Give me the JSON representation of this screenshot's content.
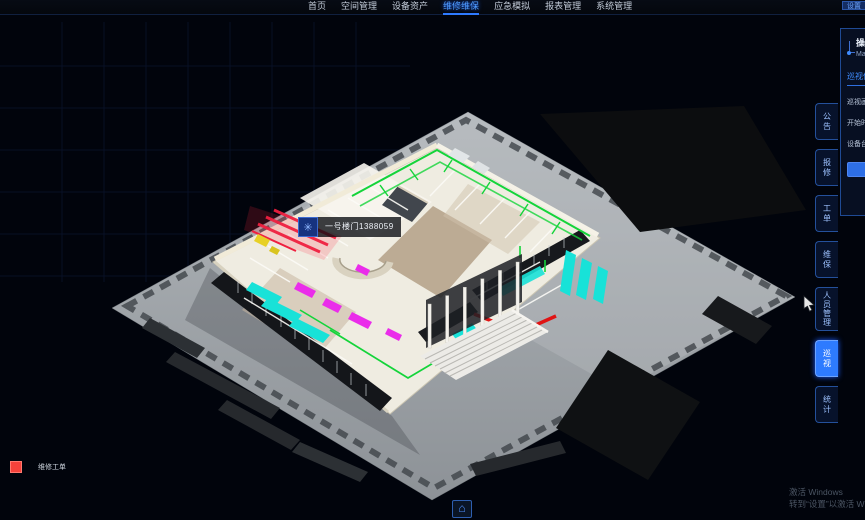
{
  "nav": {
    "items": [
      "首页",
      "空间管理",
      "设备资产",
      "维修维保",
      "应急模拟",
      "报表管理",
      "系统管理"
    ],
    "active": "维修维保",
    "active_index": 3,
    "corner_chip": "设置"
  },
  "side_rail": {
    "tabs": [
      "公告",
      "报修",
      "工单",
      "维保",
      "人员管理",
      "巡视",
      "统计"
    ],
    "active": "巡视",
    "active_index": 5
  },
  "panel": {
    "title_cn": "操作指南",
    "title_en": "Manual",
    "section_header": "巡视信息",
    "rows": [
      "巡视画面",
      "开始时间",
      "设备台账"
    ],
    "action_button": "查看详情"
  },
  "model_tooltip": {
    "icon": "fan-icon",
    "icon_glyph": "✳",
    "text": "一号楼门1388059"
  },
  "legend": {
    "swatch_color": "#f5423b",
    "label": "维修工单"
  },
  "viewport": {
    "home_button_icon": "home-icon",
    "home_glyph": "⌂"
  },
  "watermark": {
    "line1": "激活 Windows",
    "line2": "转到“设置”以激活 Windows。"
  },
  "colors": {
    "accent_blue": "#2e7bff",
    "nav_active": "#4f9dff",
    "pipe_green": "#14d43a",
    "duct_red": "#ef2040",
    "equipment_magenta": "#ea2cea",
    "glass_cyan": "#18e2d8",
    "platform_gray": "#9aa0a5",
    "asphalt_dark": "#0c0d0f",
    "background": "#01040c"
  }
}
